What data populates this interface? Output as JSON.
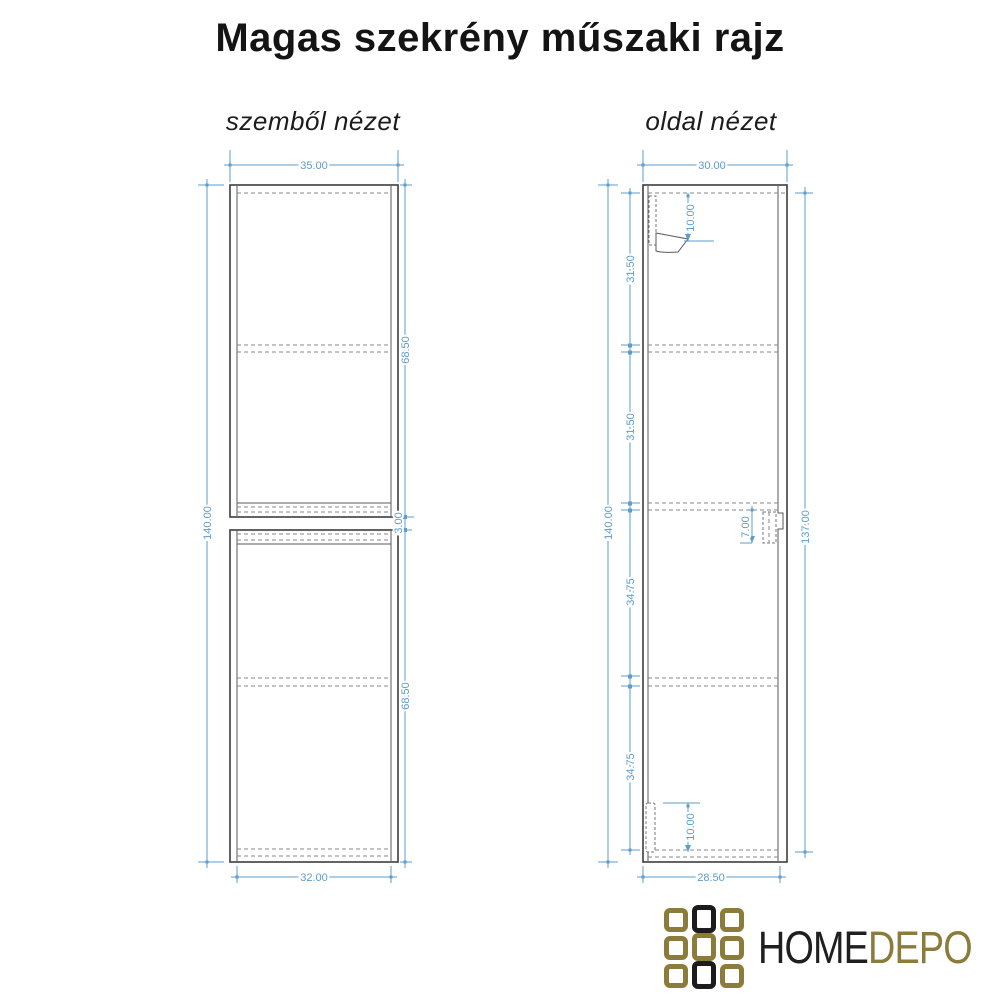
{
  "title": "Magas szekrény műszaki rajz",
  "colors": {
    "dimension_blue": "#5d9cce",
    "drawing_line": "#3d3d3d",
    "dashed_line": "#878787",
    "logo_gold": "#8b7c3c",
    "logo_black": "#1c1c1c"
  },
  "front_view": {
    "label": "szemből nézet",
    "dimensions": {
      "width_top": "35.00",
      "height_left": "140.00",
      "upper_module_right": "68.50",
      "gap_right": "3.00",
      "lower_module_right": "68.50",
      "width_bottom": "32.00"
    }
  },
  "side_view": {
    "label": "oldal nézet",
    "dimensions": {
      "depth_top": "30.00",
      "top_bracket": "10.00",
      "segment1_left": "31.50",
      "segment2_left": "31.50",
      "height_left": "140.00",
      "segment3_left": "34.75",
      "segment4_left": "34.75",
      "height_right": "137.00",
      "mid_bracket": "7.00",
      "bottom_bracket": "10.00",
      "depth_bottom": "28.50"
    }
  },
  "logo": {
    "home": "HOME",
    "depo": "DEPO",
    "grid": [
      [
        "gold",
        "black",
        "gold"
      ],
      [
        "gold",
        "gold",
        "gold"
      ],
      [
        "gold",
        "black",
        "gold"
      ]
    ]
  }
}
